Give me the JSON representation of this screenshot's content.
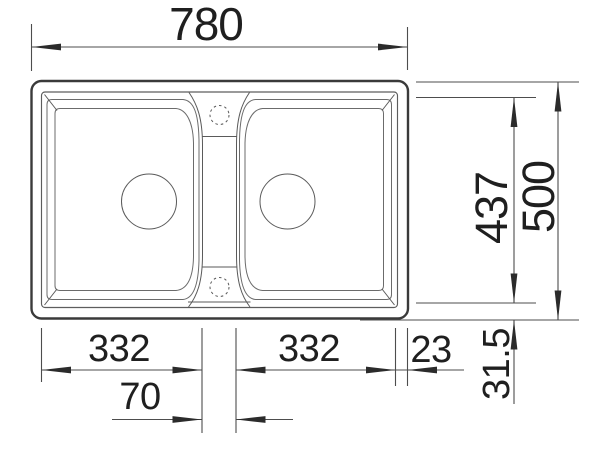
{
  "colors": {
    "background": "#ffffff",
    "outline": "#3a3a3a",
    "detail_lines": "#6b6b6b",
    "dimension_lines": "#4d4d4d",
    "text": "#1f1f1f"
  },
  "dims": {
    "overall_width": "780",
    "overall_depth": "500",
    "inner_depth": "437",
    "left_bowl_width": "332",
    "right_bowl_width": "332",
    "center_ledge_width": "70",
    "right_rim_width": "23",
    "rim_depth": "31.5"
  }
}
